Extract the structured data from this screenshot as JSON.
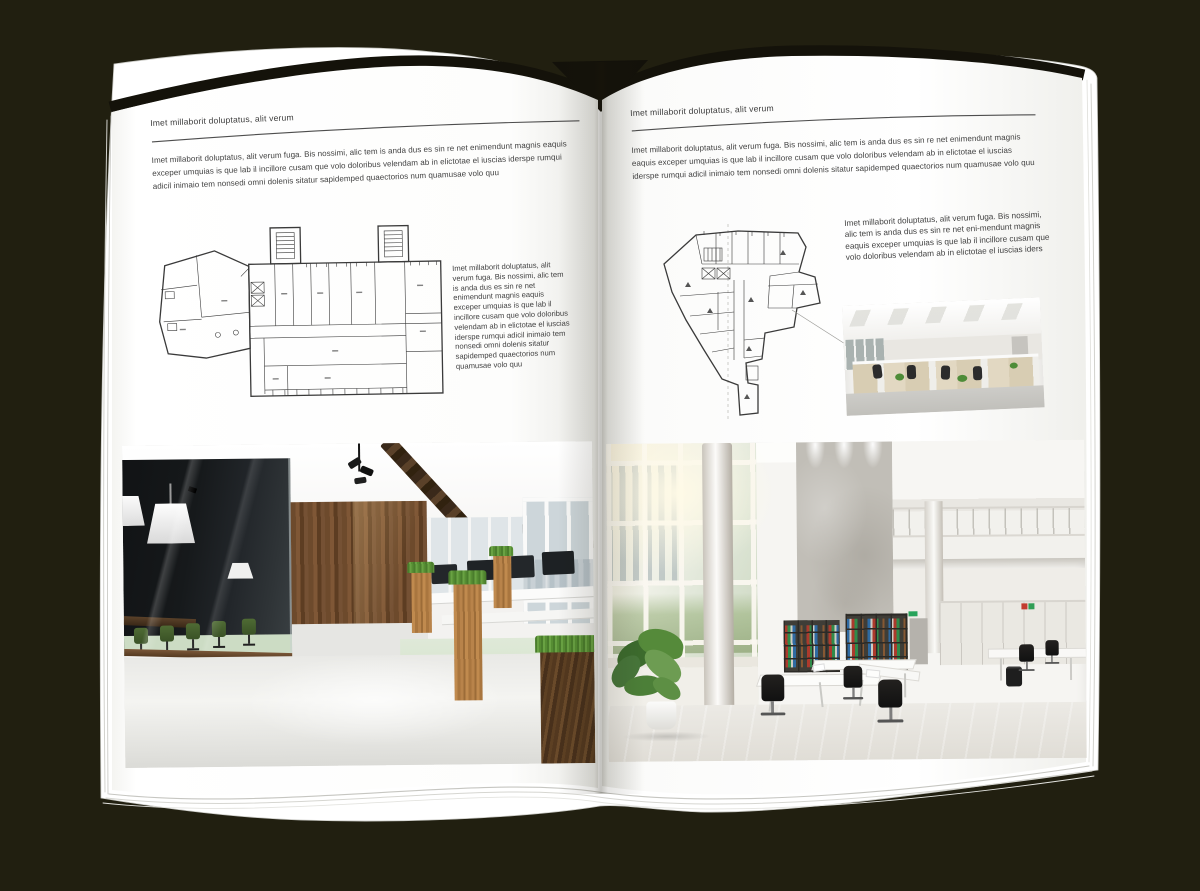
{
  "colors": {
    "background": "#211f10",
    "page": "#ffffff",
    "text": "#3f3f3f",
    "rule": "#4e4e4e",
    "plan_line": "#3a3a3a",
    "chair_green": "#4f6b34",
    "binder_red": "#b23a2c",
    "binder_green": "#2f8f4b",
    "binder_blue": "#2e6da8"
  },
  "left_page": {
    "header": "Imet millaborit doluptatus, alit verum",
    "intro": "Imet millaborit doluptatus, alit verum fuga. Bis nossimi, alic tem is anda dus es sin re net enimendunt magnis eaquis exceper umquias is que lab il incillore cusam que volo doloribus velendam ab in elictotae el iuscias iderspe rumqui adicil inimaio tem nonsedi omni dolenis sitatur sapidemped quaectorios num quamusae volo quu",
    "caption": "Imet millaborit doluptatus, alit verum fuga. Bis nossimi, alic tem is anda dus es sin re net enimendunt magnis eaquis exceper umquias is que lab il incillore cusam que volo doloribus velendam ab in elictotae el iuscias iderspe rumqui adicil inimaio tem nonsedi omni dolenis sitatur sapidemped quaectorios num quamusae volo quu"
  },
  "right_page": {
    "header": "Imet millaborit doluptatus, alit verum",
    "intro": "Imet millaborit doluptatus, alit verum fuga. Bis nossimi, alic tem is anda dus es sin re net enimendunt magnis eaquis exceper umquias is que lab il incillore cusam que volo doloribus velendam ab in elictotae el iuscias iderspe rumqui adicil inimaio tem nonsedi omni dolenis sitatur sapidemped quaectorios num quamusae volo quu",
    "caption": "Imet millaborit doluptatus, alit verum fuga. Bis nossimi, alic tem is anda dus es sin re net eni-mendunt magnis eaquis exceper umquias is que lab il incillore cusam que volo doloribus velendam ab in elictotae el iuscias iders"
  }
}
